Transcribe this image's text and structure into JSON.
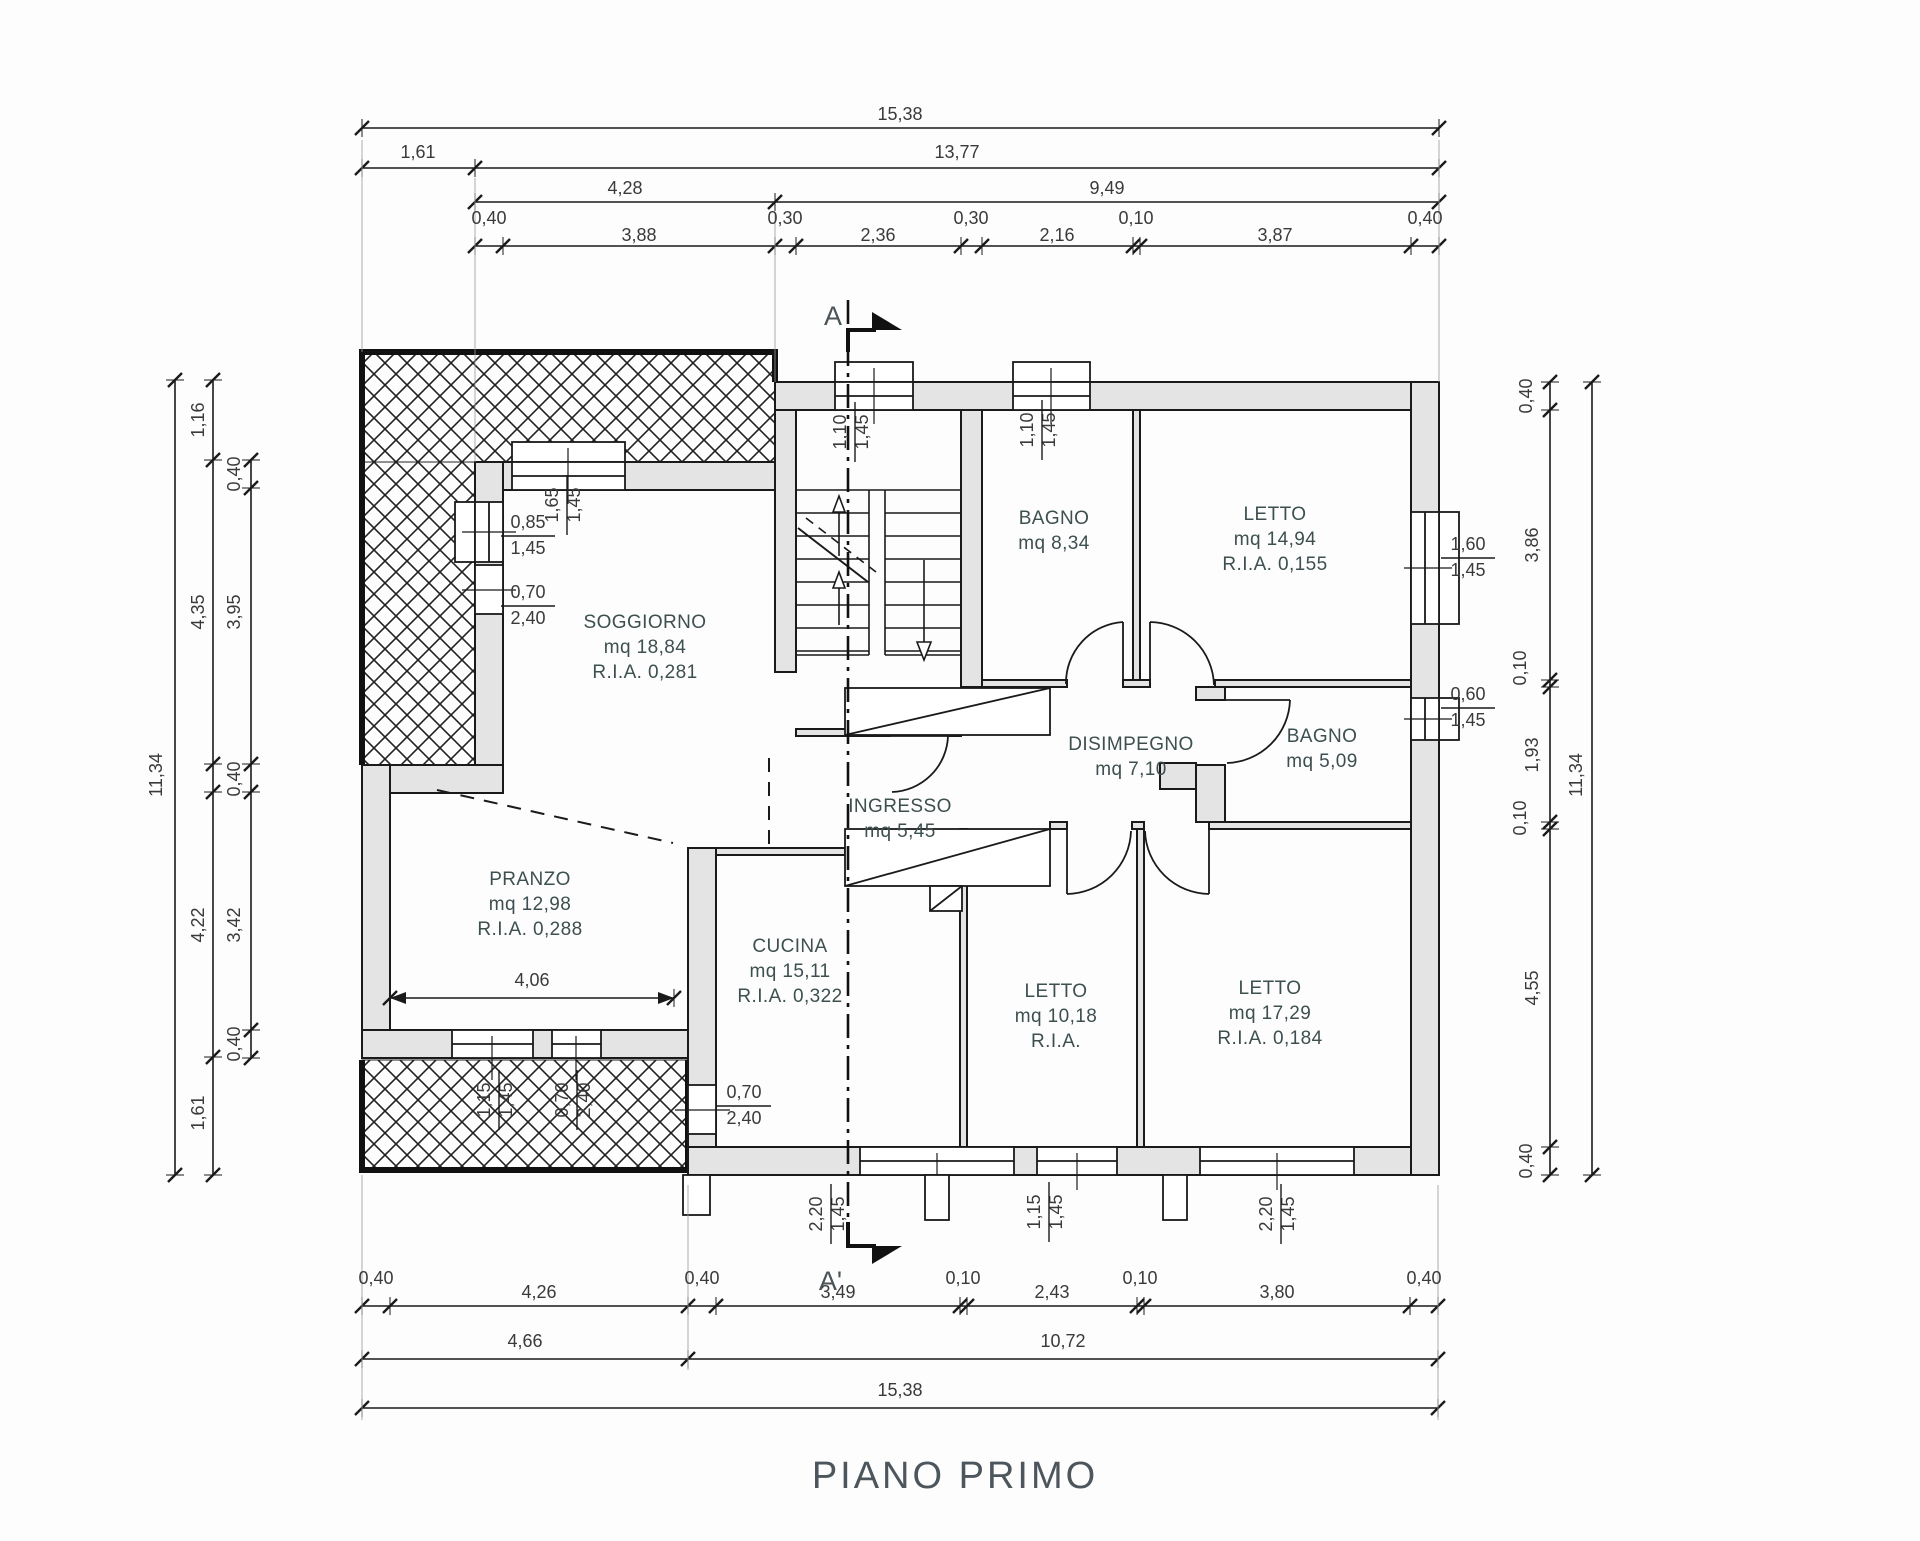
{
  "title": "PIANO PRIMO",
  "section_markers": {
    "top": "A",
    "bottom": "A'"
  },
  "colors": {
    "wall_fill": "#e4e4e4",
    "line": "#1a1a1a",
    "room_text": "#3d4f4f",
    "dim_text": "#3a3a3a",
    "title_text": "#4d565c"
  },
  "rooms": [
    {
      "name": "SOGGIORNO",
      "lines": [
        "SOGGIORNO",
        "mq 18,84",
        "R.I.A. 0,281"
      ],
      "x": 645,
      "y": 628
    },
    {
      "name": "PRANZO",
      "lines": [
        "PRANZO",
        "mq 12,98",
        "R.I.A. 0,288"
      ],
      "x": 530,
      "y": 885
    },
    {
      "name": "CUCINA",
      "lines": [
        "CUCINA",
        "mq 15,11",
        "R.I.A. 0,322"
      ],
      "x": 790,
      "y": 952
    },
    {
      "name": "INGRESSO",
      "lines": [
        "INGRESSO",
        "mq 5,45"
      ],
      "x": 900,
      "y": 812
    },
    {
      "name": "DISIMPEGNO",
      "lines": [
        "DISIMPEGNO",
        "mq 7,10"
      ],
      "x": 1131,
      "y": 750
    },
    {
      "name": "BAGNO-1",
      "lines": [
        "BAGNO",
        "mq 8,34"
      ],
      "x": 1054,
      "y": 524
    },
    {
      "name": "LETTO-1",
      "lines": [
        "LETTO",
        "mq 14,94",
        "R.I.A. 0,155"
      ],
      "x": 1275,
      "y": 520
    },
    {
      "name": "BAGNO-2",
      "lines": [
        "BAGNO",
        "mq 5,09"
      ],
      "x": 1322,
      "y": 742
    },
    {
      "name": "LETTO-2",
      "lines": [
        "LETTO",
        "mq 10,18",
        "R.I.A."
      ],
      "x": 1056,
      "y": 997
    },
    {
      "name": "LETTO-3",
      "lines": [
        "LETTO",
        "mq 17,29",
        "R.I.A. 0,184"
      ],
      "x": 1270,
      "y": 994
    }
  ],
  "dim_labels": [
    {
      "v": "15,38",
      "x": 900,
      "y": 120
    },
    {
      "v": "1,61",
      "x": 418,
      "y": 158
    },
    {
      "v": "13,77",
      "x": 957,
      "y": 158
    },
    {
      "v": "4,28",
      "x": 625,
      "y": 194
    },
    {
      "v": "9,49",
      "x": 1107,
      "y": 194
    },
    {
      "v": "0,40",
      "x": 489,
      "y": 224
    },
    {
      "v": "3,88",
      "x": 639,
      "y": 241
    },
    {
      "v": "0,30",
      "x": 785,
      "y": 224
    },
    {
      "v": "2,36",
      "x": 878,
      "y": 241
    },
    {
      "v": "0,30",
      "x": 971,
      "y": 224
    },
    {
      "v": "2,16",
      "x": 1057,
      "y": 241
    },
    {
      "v": "0,10",
      "x": 1136,
      "y": 224
    },
    {
      "v": "3,87",
      "x": 1275,
      "y": 241
    },
    {
      "v": "0,40",
      "x": 1425,
      "y": 224
    },
    {
      "v": "0,40",
      "x": 376,
      "y": 1284
    },
    {
      "v": "4,26",
      "x": 539,
      "y": 1298
    },
    {
      "v": "0,40",
      "x": 702,
      "y": 1284
    },
    {
      "v": "3,49",
      "x": 838,
      "y": 1298
    },
    {
      "v": "0,10",
      "x": 963,
      "y": 1284
    },
    {
      "v": "2,43",
      "x": 1052,
      "y": 1298
    },
    {
      "v": "0,10",
      "x": 1140,
      "y": 1284
    },
    {
      "v": "3,80",
      "x": 1277,
      "y": 1298
    },
    {
      "v": "0,40",
      "x": 1424,
      "y": 1284
    },
    {
      "v": "4,66",
      "x": 525,
      "y": 1347
    },
    {
      "v": "10,72",
      "x": 1063,
      "y": 1347
    },
    {
      "v": "15,38",
      "x": 900,
      "y": 1396
    },
    {
      "v": "1,16",
      "x": 204,
      "y": 420,
      "rot": true
    },
    {
      "v": "0,40",
      "x": 240,
      "y": 474,
      "rot": true
    },
    {
      "v": "4,35",
      "x": 204,
      "y": 612,
      "rot": true
    },
    {
      "v": "3,95",
      "x": 240,
      "y": 612,
      "rot": true
    },
    {
      "v": "0,40",
      "x": 240,
      "y": 779,
      "rot": true
    },
    {
      "v": "4,22",
      "x": 204,
      "y": 925,
      "rot": true
    },
    {
      "v": "3,42",
      "x": 240,
      "y": 925,
      "rot": true
    },
    {
      "v": "0,40",
      "x": 240,
      "y": 1044,
      "rot": true
    },
    {
      "v": "1,61",
      "x": 204,
      "y": 1113,
      "rot": true
    },
    {
      "v": "11,34",
      "x": 162,
      "y": 775,
      "rot": true
    },
    {
      "v": "0,40",
      "x": 1532,
      "y": 396,
      "rot": true
    },
    {
      "v": "3,86",
      "x": 1538,
      "y": 545,
      "rot": true
    },
    {
      "v": "0,10",
      "x": 1526,
      "y": 668,
      "rot": true
    },
    {
      "v": "1,93",
      "x": 1538,
      "y": 755,
      "rot": true
    },
    {
      "v": "0,10",
      "x": 1526,
      "y": 818,
      "rot": true
    },
    {
      "v": "4,55",
      "x": 1538,
      "y": 988,
      "rot": true
    },
    {
      "v": "0,40",
      "x": 1532,
      "y": 1161,
      "rot": true
    },
    {
      "v": "11,34",
      "x": 1582,
      "y": 775,
      "rot": true
    },
    {
      "v": "4,06",
      "x": 532,
      "y": 986
    }
  ],
  "window_labels": [
    {
      "a": "1,65",
      "b": "1,45",
      "x": 558,
      "y": 505,
      "rot": true
    },
    {
      "a": "1,10",
      "b": "1,45",
      "x": 846,
      "y": 432,
      "rot": true
    },
    {
      "a": "1,10",
      "b": "1,45",
      "x": 1033,
      "y": 430,
      "rot": true
    },
    {
      "a": "0,85",
      "b": "1,45",
      "x": 528,
      "y": 528,
      "rot": false
    },
    {
      "a": "0,70",
      "b": "2,40",
      "x": 528,
      "y": 598,
      "rot": false
    },
    {
      "a": "1,60",
      "b": "1,45",
      "x": 1468,
      "y": 550,
      "rot": false
    },
    {
      "a": "0,60",
      "b": "1,45",
      "x": 1468,
      "y": 700,
      "rot": false
    },
    {
      "a": "0,70",
      "b": "2,40",
      "x": 744,
      "y": 1098,
      "rot": false
    },
    {
      "a": "1,15",
      "b": "1,45",
      "x": 490,
      "y": 1100,
      "rot": true
    },
    {
      "a": "0,70",
      "b": "2,40",
      "x": 568,
      "y": 1100,
      "rot": true
    },
    {
      "a": "2,20",
      "b": "1,45",
      "x": 822,
      "y": 1214,
      "rot": true
    },
    {
      "a": "1,15",
      "b": "1,45",
      "x": 1040,
      "y": 1212,
      "rot": true
    },
    {
      "a": "2,20",
      "b": "1,45",
      "x": 1272,
      "y": 1214,
      "rot": true
    }
  ]
}
